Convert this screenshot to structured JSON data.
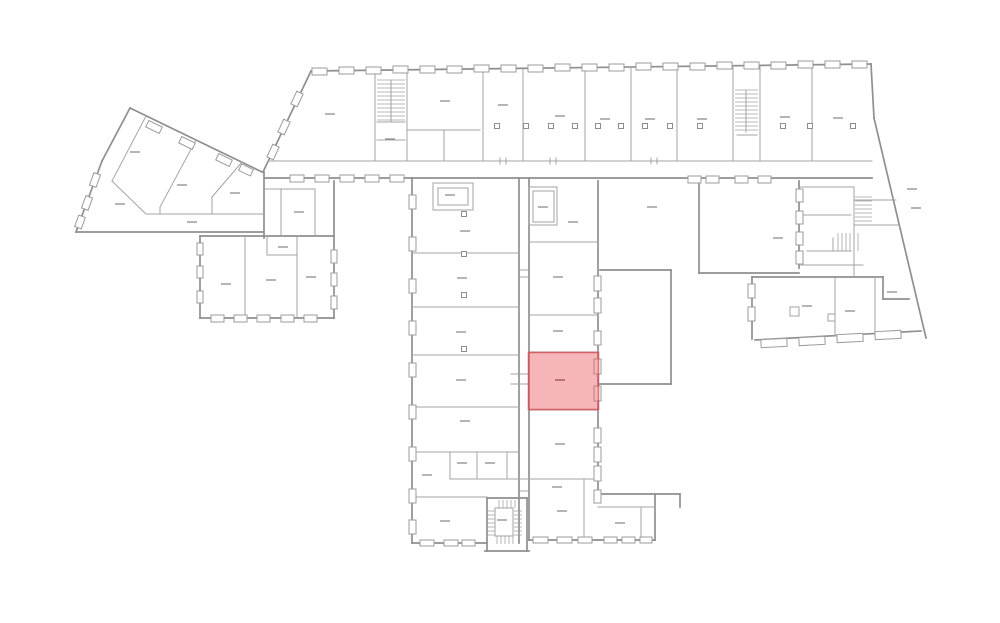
{
  "floorplan": {
    "canvas": {
      "width": 1000,
      "height": 623
    },
    "colors": {
      "background": "#ffffff",
      "wall_outer": "#8f8f8f",
      "wall_inner": "#a3a3a3",
      "window_stroke": "#9b9b9b",
      "window_fill": "#ffffff",
      "dash": "#8d8d8d",
      "highlight_fill": "rgba(236,92,97,0.45)",
      "highlight_stroke": "rgba(208,73,82,0.75)",
      "highlight_dash": "#a8565b"
    },
    "highlighted_room": {
      "x": 528.5,
      "y": 352.5,
      "w": 70,
      "h": 57,
      "label_dash": [
        560,
        380
      ]
    },
    "walls_outer": [
      [
        311,
        71,
        871,
        64
      ],
      [
        311,
        71,
        263,
        172
      ],
      [
        871,
        64,
        874,
        118
      ],
      [
        874,
        118,
        926,
        338
      ],
      [
        130,
        108,
        262,
        172
      ],
      [
        130,
        108,
        102,
        161
      ],
      [
        102,
        161,
        76,
        232
      ],
      [
        76,
        232,
        263,
        232
      ],
      [
        264,
        172,
        264,
        238
      ],
      [
        200,
        236,
        334,
        236
      ],
      [
        200,
        236,
        200,
        318
      ],
      [
        200,
        318,
        334,
        318
      ],
      [
        334,
        181,
        334,
        318
      ],
      [
        265,
        178,
        872,
        178
      ],
      [
        412,
        178,
        412,
        543
      ],
      [
        412,
        543,
        487,
        543
      ],
      [
        519,
        178,
        519,
        543
      ],
      [
        529,
        178,
        529,
        540
      ],
      [
        598,
        181,
        598,
        494
      ],
      [
        529,
        540,
        597,
        540
      ],
      [
        597,
        494,
        680,
        494
      ],
      [
        680,
        494,
        680,
        507
      ],
      [
        655,
        494,
        655,
        540
      ],
      [
        597,
        540,
        655,
        540
      ],
      [
        600,
        270,
        671,
        270
      ],
      [
        671,
        270,
        671,
        384
      ],
      [
        600,
        384,
        671,
        384
      ],
      [
        699,
        181,
        699,
        273
      ],
      [
        699,
        273,
        799,
        273
      ],
      [
        799,
        181,
        799,
        268
      ],
      [
        752,
        277,
        883,
        277
      ],
      [
        752,
        277,
        752,
        339
      ],
      [
        755,
        340,
        921,
        331
      ],
      [
        883,
        277,
        883,
        299
      ],
      [
        883,
        299,
        909,
        299
      ],
      [
        487,
        498,
        487,
        551
      ],
      [
        527,
        498,
        527,
        551
      ],
      [
        485,
        551,
        529,
        551
      ],
      [
        487,
        498,
        527,
        498
      ]
    ],
    "walls_inner": [
      [
        268,
        161,
        872,
        161
      ],
      [
        375,
        71,
        375,
        161
      ],
      [
        407,
        71,
        407,
        161
      ],
      [
        483,
        69,
        483,
        161
      ],
      [
        523,
        68,
        523,
        161
      ],
      [
        585,
        68,
        585,
        161
      ],
      [
        631,
        67,
        631,
        161
      ],
      [
        677,
        67,
        677,
        161
      ],
      [
        733,
        66,
        733,
        161
      ],
      [
        760,
        66,
        760,
        161
      ],
      [
        812,
        65,
        812,
        161
      ],
      [
        407,
        130,
        480,
        130
      ],
      [
        444,
        130,
        444,
        161
      ],
      [
        391,
        80,
        391,
        122
      ],
      [
        377,
        122,
        405,
        122
      ],
      [
        377,
        140,
        405,
        140
      ],
      [
        746,
        90,
        746,
        132
      ],
      [
        737,
        135,
        757,
        135
      ],
      [
        146,
        116,
        112,
        181
      ],
      [
        112,
        181,
        146,
        214
      ],
      [
        196,
        140,
        160,
        207
      ],
      [
        160,
        207,
        160,
        214
      ],
      [
        242,
        162,
        212,
        197
      ],
      [
        212,
        197,
        212,
        214
      ],
      [
        147,
        214,
        264,
        214
      ],
      [
        265,
        189,
        315,
        189
      ],
      [
        281,
        189,
        281,
        236
      ],
      [
        315,
        189,
        315,
        236
      ],
      [
        245,
        236,
        245,
        318
      ],
      [
        297,
        236,
        297,
        318
      ],
      [
        267,
        236,
        267,
        255
      ],
      [
        267,
        255,
        297,
        255
      ],
      [
        412,
        253,
        519,
        253
      ],
      [
        412,
        307,
        519,
        307
      ],
      [
        412,
        355,
        519,
        355
      ],
      [
        412,
        407,
        519,
        407
      ],
      [
        412,
        452,
        519,
        452
      ],
      [
        450,
        479,
        598,
        479
      ],
      [
        450,
        452,
        450,
        479
      ],
      [
        477,
        452,
        477,
        479
      ],
      [
        507,
        452,
        507,
        479
      ],
      [
        412,
        497,
        487,
        497
      ],
      [
        529,
        242,
        598,
        242
      ],
      [
        529,
        315,
        598,
        315
      ],
      [
        529,
        352,
        598,
        352
      ],
      [
        529,
        410,
        598,
        410
      ],
      [
        584,
        480,
        584,
        540
      ],
      [
        641,
        507,
        641,
        540
      ],
      [
        598,
        507,
        655,
        507
      ],
      [
        511,
        374,
        529,
        374
      ],
      [
        511,
        384,
        529,
        384
      ],
      [
        519,
        270,
        529,
        270
      ],
      [
        519,
        277,
        529,
        277
      ],
      [
        519,
        491,
        529,
        491
      ],
      [
        500,
        158,
        500,
        164
      ],
      [
        506,
        158,
        506,
        164
      ],
      [
        550,
        158,
        550,
        164
      ],
      [
        556,
        158,
        556,
        164
      ],
      [
        651,
        158,
        651,
        164
      ],
      [
        657,
        158,
        657,
        164
      ],
      [
        800,
        187,
        854,
        187
      ],
      [
        854,
        187,
        854,
        277
      ],
      [
        801,
        215,
        851,
        215
      ],
      [
        807,
        251,
        851,
        251
      ],
      [
        833,
        238,
        833,
        251
      ],
      [
        801,
        265,
        863,
        265
      ],
      [
        854,
        200,
        896,
        200
      ],
      [
        854,
        225,
        899,
        225
      ],
      [
        835,
        278,
        835,
        336
      ],
      [
        875,
        277,
        875,
        333
      ]
    ],
    "rects": [
      [
        433,
        183,
        40,
        27
      ],
      [
        438,
        188,
        30,
        17
      ],
      [
        529,
        187,
        28,
        38
      ],
      [
        533,
        191,
        21,
        31
      ],
      [
        790,
        307,
        9,
        9
      ],
      [
        828,
        314,
        7,
        7
      ],
      [
        495,
        508,
        18,
        28
      ]
    ],
    "windows": [
      [
        312,
        68,
        15,
        7
      ],
      [
        339,
        67,
        15,
        7
      ],
      [
        366,
        67,
        15,
        7
      ],
      [
        393,
        66,
        15,
        7
      ],
      [
        420,
        66,
        15,
        7
      ],
      [
        447,
        66,
        15,
        7
      ],
      [
        474,
        65,
        15,
        7
      ],
      [
        501,
        65,
        15,
        7
      ],
      [
        528,
        65,
        15,
        7
      ],
      [
        555,
        64,
        15,
        7
      ],
      [
        582,
        64,
        15,
        7
      ],
      [
        609,
        64,
        15,
        7
      ],
      [
        636,
        63,
        15,
        7
      ],
      [
        663,
        63,
        15,
        7
      ],
      [
        690,
        63,
        15,
        7
      ],
      [
        717,
        62,
        15,
        7
      ],
      [
        744,
        62,
        15,
        7
      ],
      [
        771,
        62,
        15,
        7
      ],
      [
        798,
        61,
        15,
        7
      ],
      [
        825,
        61,
        15,
        7
      ],
      [
        852,
        61,
        15,
        7
      ],
      [
        290,
        175,
        14,
        7
      ],
      [
        315,
        175,
        14,
        7
      ],
      [
        340,
        175,
        14,
        7
      ],
      [
        365,
        175,
        14,
        7
      ],
      [
        390,
        175,
        14,
        7
      ],
      [
        688,
        176,
        13,
        7
      ],
      [
        706,
        176,
        13,
        7
      ],
      [
        735,
        176,
        13,
        7
      ],
      [
        758,
        176,
        13,
        7
      ],
      [
        409,
        195,
        7,
        14
      ],
      [
        409,
        237,
        7,
        14
      ],
      [
        409,
        279,
        7,
        14
      ],
      [
        409,
        321,
        7,
        14
      ],
      [
        409,
        363,
        7,
        14
      ],
      [
        409,
        405,
        7,
        14
      ],
      [
        409,
        447,
        7,
        14
      ],
      [
        409,
        489,
        7,
        14
      ],
      [
        409,
        520,
        7,
        14
      ],
      [
        594,
        276,
        7,
        15
      ],
      [
        594,
        298,
        7,
        15
      ],
      [
        594,
        331,
        7,
        14
      ],
      [
        594,
        359,
        7,
        15
      ],
      [
        594,
        386,
        7,
        15
      ],
      [
        594,
        428,
        7,
        15
      ],
      [
        594,
        447,
        7,
        15
      ],
      [
        594,
        466,
        7,
        15
      ],
      [
        594,
        490,
        7,
        13
      ],
      [
        796,
        189,
        7,
        13
      ],
      [
        796,
        211,
        7,
        13
      ],
      [
        796,
        232,
        7,
        13
      ],
      [
        796,
        251,
        7,
        13
      ],
      [
        211,
        315,
        13,
        7
      ],
      [
        234,
        315,
        13,
        7
      ],
      [
        257,
        315,
        13,
        7
      ],
      [
        281,
        315,
        13,
        7
      ],
      [
        304,
        315,
        13,
        7
      ],
      [
        197,
        243,
        6,
        12
      ],
      [
        197,
        266,
        6,
        12
      ],
      [
        197,
        291,
        6,
        12
      ],
      [
        331,
        250,
        6,
        13
      ],
      [
        331,
        273,
        6,
        13
      ],
      [
        331,
        296,
        6,
        13
      ],
      [
        748,
        284,
        7,
        14
      ],
      [
        748,
        307,
        7,
        14
      ],
      [
        420,
        540,
        14,
        6
      ],
      [
        444,
        540,
        14,
        6
      ],
      [
        462,
        540,
        13,
        6
      ],
      [
        533,
        537,
        15,
        6
      ],
      [
        557,
        537,
        15,
        6
      ],
      [
        578,
        537,
        14,
        6
      ],
      [
        604,
        537,
        13,
        6
      ],
      [
        622,
        537,
        13,
        6
      ],
      [
        640,
        537,
        12,
        6
      ]
    ],
    "windows_rotated": [
      [
        154,
        127,
        15,
        7,
        26
      ],
      [
        187,
        143,
        15,
        7,
        26
      ],
      [
        224,
        160,
        15,
        7,
        26
      ],
      [
        246,
        170,
        13,
        7,
        26
      ],
      [
        297,
        99,
        14,
        7,
        115
      ],
      [
        284,
        127,
        14,
        7,
        115
      ],
      [
        273,
        152,
        14,
        7,
        115
      ],
      [
        95,
        180,
        13,
        7,
        110
      ],
      [
        87,
        203,
        13,
        7,
        110
      ],
      [
        80,
        222,
        12,
        7,
        110
      ],
      [
        774,
        343,
        26,
        8,
        -3
      ],
      [
        812,
        341,
        26,
        8,
        -3
      ],
      [
        850,
        338,
        26,
        8,
        -3
      ],
      [
        888,
        335,
        26,
        8,
        -3
      ]
    ],
    "stairs": [
      {
        "x": 377,
        "y": 80,
        "w": 28,
        "h": 42,
        "dir": "h",
        "step": 4
      },
      {
        "x": 735,
        "y": 90,
        "w": 23,
        "h": 42,
        "dir": "h",
        "step": 4
      },
      {
        "x": 855,
        "y": 197,
        "w": 17,
        "h": 24,
        "dir": "h",
        "step": 4
      },
      {
        "x": 838,
        "y": 233,
        "w": 20,
        "h": 18,
        "dir": "v",
        "step": 4
      },
      {
        "x": 499,
        "y": 500,
        "w": 19,
        "h": 8,
        "dir": "v",
        "step": 4
      },
      {
        "x": 487,
        "y": 511,
        "w": 8,
        "h": 24,
        "dir": "h",
        "step": 4
      },
      {
        "x": 514,
        "y": 511,
        "w": 8,
        "h": 24,
        "dir": "h",
        "step": 4
      },
      {
        "x": 497,
        "y": 536,
        "w": 19,
        "h": 8,
        "dir": "v",
        "step": 4
      }
    ],
    "pillars": [
      [
        497,
        126
      ],
      [
        526,
        126
      ],
      [
        551,
        126
      ],
      [
        575,
        126
      ],
      [
        598,
        126
      ],
      [
        621,
        126
      ],
      [
        645,
        126
      ],
      [
        670,
        126
      ],
      [
        700,
        126
      ],
      [
        783,
        126
      ],
      [
        810,
        126
      ],
      [
        853,
        126
      ],
      [
        464,
        214
      ],
      [
        464,
        254
      ],
      [
        464,
        295
      ],
      [
        464,
        349
      ]
    ],
    "label_dashes": [
      [
        330,
        114
      ],
      [
        445,
        101
      ],
      [
        503,
        105
      ],
      [
        560,
        116
      ],
      [
        605,
        119
      ],
      [
        650,
        119
      ],
      [
        702,
        119
      ],
      [
        785,
        117
      ],
      [
        838,
        118
      ],
      [
        390,
        139
      ],
      [
        135,
        152
      ],
      [
        182,
        185
      ],
      [
        235,
        193
      ],
      [
        120,
        204
      ],
      [
        192,
        222
      ],
      [
        299,
        212
      ],
      [
        226,
        284
      ],
      [
        271,
        280
      ],
      [
        311,
        277
      ],
      [
        283,
        247
      ],
      [
        450,
        195
      ],
      [
        465,
        231
      ],
      [
        462,
        278
      ],
      [
        461,
        332
      ],
      [
        461,
        380
      ],
      [
        465,
        421
      ],
      [
        427,
        475
      ],
      [
        462,
        463
      ],
      [
        490,
        463
      ],
      [
        445,
        521
      ],
      [
        502,
        520
      ],
      [
        543,
        207
      ],
      [
        573,
        222
      ],
      [
        558,
        277
      ],
      [
        558,
        331
      ],
      [
        560,
        444
      ],
      [
        557,
        487
      ],
      [
        562,
        511
      ],
      [
        620,
        523
      ],
      [
        652,
        207
      ],
      [
        778,
        238
      ],
      [
        912,
        189
      ],
      [
        916,
        208
      ],
      [
        807,
        306
      ],
      [
        850,
        311
      ],
      [
        892,
        292
      ]
    ]
  }
}
